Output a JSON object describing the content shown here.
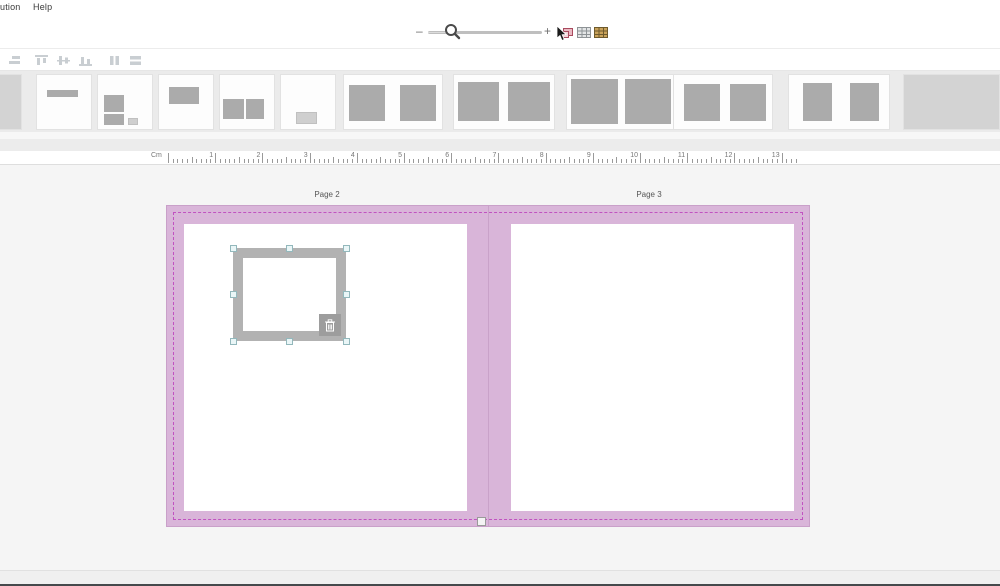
{
  "colors": {
    "spread_bg": "#d9b5d9",
    "spread_border": "#c9a0c9",
    "bleed_dash": "#c152c1",
    "canvas_bg": "#f5f5f5",
    "strip_bg": "#ebebeb",
    "frame_gray": "#b2b2b2",
    "handle_fill": "#eaf6f7",
    "handle_border": "#93b8bc",
    "shape_dark": "#ababab",
    "shape_light": "#cfcfcf"
  },
  "menu_bar": {
    "items": [
      {
        "label": "ution"
      },
      {
        "label": "Help"
      }
    ]
  },
  "zoom_toolbar": {
    "minus_label": "–",
    "plus_label": "+",
    "icons": [
      {
        "name": "move-photo-icon"
      },
      {
        "name": "grid-layout-icon"
      },
      {
        "name": "photo-grid-icon"
      }
    ]
  },
  "align_toolbar": {
    "icons": [
      {
        "name": "align-right-icon"
      },
      {
        "name": "align-top-icon"
      },
      {
        "name": "align-middle-icon"
      },
      {
        "name": "align-bottom-icon"
      },
      {
        "name": "distribute-horizontal-icon"
      },
      {
        "name": "distribute-vertical-icon"
      }
    ]
  },
  "template_strip": {
    "thumbnails": [
      {
        "kind": "filled-page",
        "left": -34,
        "width": 56,
        "boxes": [
          {
            "l": 0,
            "t": 0,
            "w": 100,
            "h": 100,
            "shade": "fill"
          }
        ]
      },
      {
        "kind": "title-line",
        "left": 36,
        "width": 56,
        "boxes": [
          {
            "l": 18,
            "t": 28,
            "w": 58,
            "h": 13,
            "shade": "dark"
          }
        ]
      },
      {
        "kind": "photo-stack",
        "left": 97,
        "width": 56,
        "boxes": [
          {
            "l": 11,
            "t": 37,
            "w": 37,
            "h": 31,
            "shade": "dark"
          },
          {
            "l": 11,
            "t": 73,
            "w": 37,
            "h": 19,
            "shade": "dark"
          },
          {
            "l": 55,
            "t": 79,
            "w": 19,
            "h": 13,
            "shade": "light"
          }
        ]
      },
      {
        "kind": "banner-top",
        "left": 158,
        "width": 56,
        "boxes": [
          {
            "l": 18,
            "t": 23,
            "w": 57,
            "h": 30,
            "shade": "dark"
          }
        ]
      },
      {
        "kind": "two-boxes",
        "left": 219,
        "width": 56,
        "boxes": [
          {
            "l": 5,
            "t": 44,
            "w": 40,
            "h": 37,
            "shade": "dark"
          },
          {
            "l": 49,
            "t": 44,
            "w": 33,
            "h": 37,
            "shade": "dark"
          }
        ]
      },
      {
        "kind": "small-corner",
        "left": 280,
        "width": 56,
        "boxes": [
          {
            "l": 27,
            "t": 68,
            "w": 39,
            "h": 22,
            "shade": "light"
          }
        ]
      },
      {
        "kind": "spread-two-medium",
        "left": 343,
        "width": 100,
        "boxes": [
          {
            "l": 5,
            "t": 18,
            "w": 37,
            "h": 67,
            "shade": "dark"
          },
          {
            "l": 57,
            "t": 18,
            "w": 37,
            "h": 67,
            "shade": "dark"
          }
        ]
      },
      {
        "kind": "spread-two-large",
        "left": 453,
        "width": 102,
        "boxes": [
          {
            "l": 4,
            "t": 13,
            "w": 41,
            "h": 73,
            "shade": "dark"
          },
          {
            "l": 54,
            "t": 13,
            "w": 42,
            "h": 73,
            "shade": "dark"
          }
        ]
      },
      {
        "kind": "spread-two-xl",
        "left": 566,
        "width": 112,
        "boxes": [
          {
            "l": 4,
            "t": 7,
            "w": 42,
            "h": 84,
            "shade": "dark"
          },
          {
            "l": 53,
            "t": 7,
            "w": 42,
            "h": 84,
            "shade": "dark"
          }
        ]
      },
      {
        "kind": "spread-two-medium-b",
        "left": 673,
        "width": 100,
        "boxes": [
          {
            "l": 10,
            "t": 17,
            "w": 37,
            "h": 68,
            "shade": "dark"
          },
          {
            "l": 57,
            "t": 17,
            "w": 37,
            "h": 68,
            "shade": "dark"
          }
        ]
      },
      {
        "kind": "spread-two-portrait",
        "left": 788,
        "width": 102,
        "boxes": [
          {
            "l": 14,
            "t": 15,
            "w": 29,
            "h": 70,
            "shade": "dark"
          },
          {
            "l": 61,
            "t": 15,
            "w": 29,
            "h": 70,
            "shade": "dark"
          }
        ]
      },
      {
        "kind": "filled-spread",
        "left": 903,
        "width": 97,
        "boxes": [
          {
            "l": 0,
            "t": 0,
            "w": 100,
            "h": 100,
            "shade": "fill"
          }
        ]
      }
    ]
  },
  "ruler": {
    "unit_label": "Cm",
    "marks": [
      1,
      2,
      3,
      4,
      5,
      6,
      7,
      8,
      9,
      10,
      11,
      12,
      13
    ]
  },
  "workspace": {
    "pages": [
      {
        "label": "Page 2"
      },
      {
        "label": "Page 3"
      }
    ]
  },
  "selection": {
    "handle_count": 8,
    "delete_icon": "trash-icon"
  }
}
